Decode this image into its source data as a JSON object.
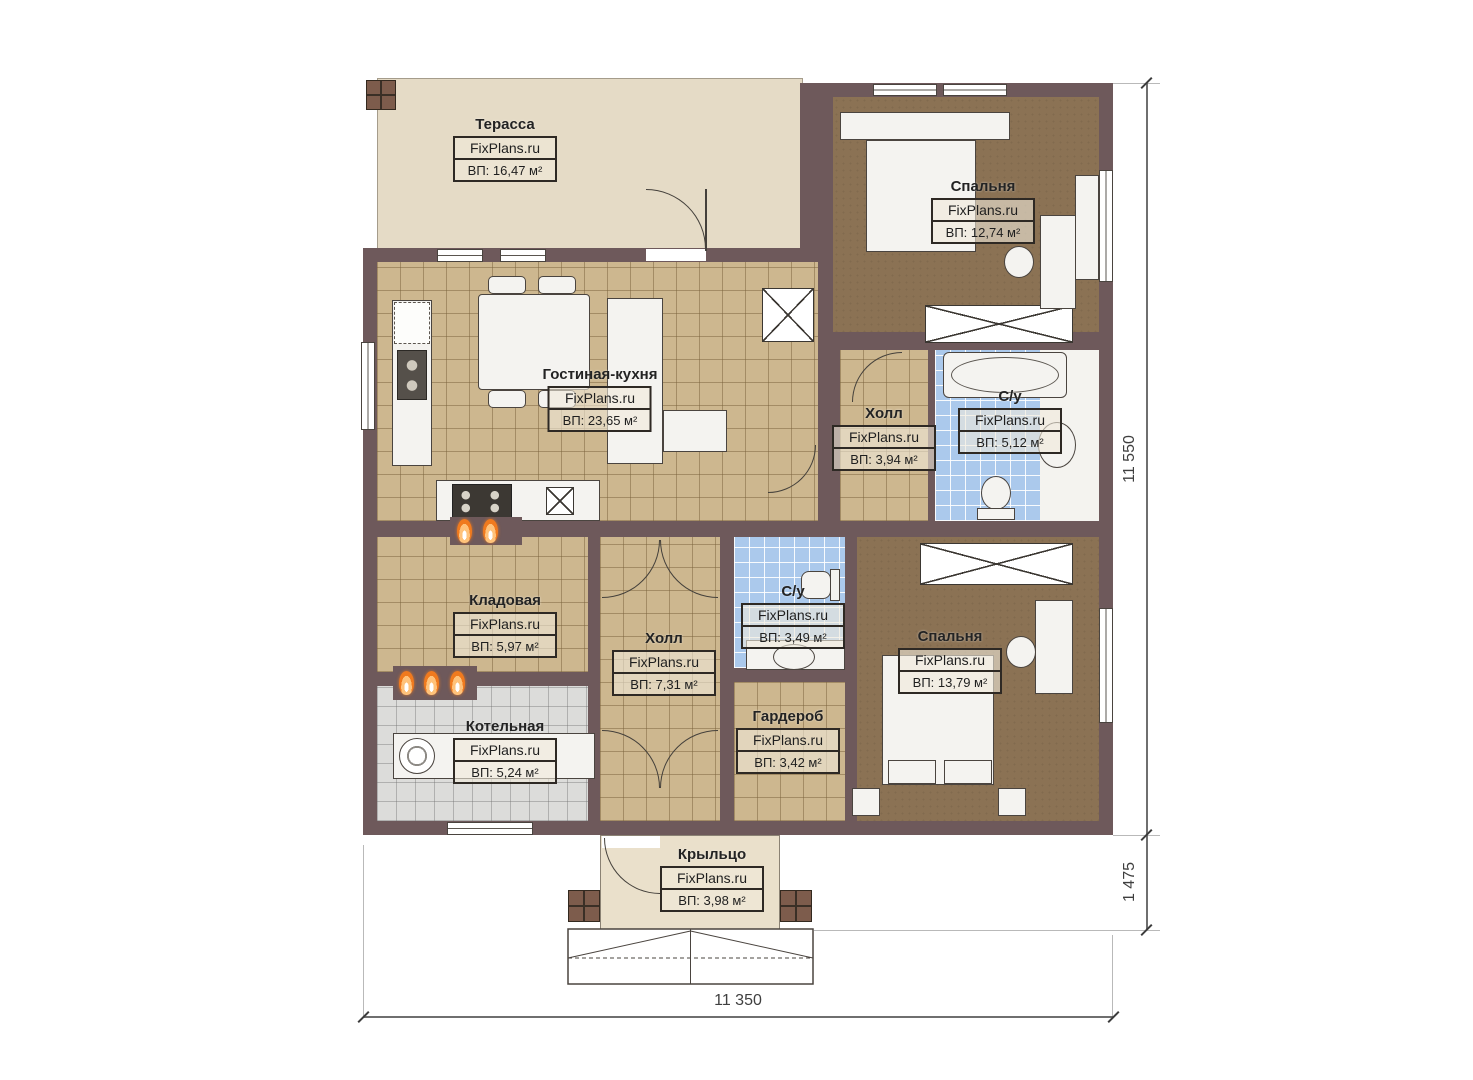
{
  "plan": {
    "watermark": "FixPlans.ru",
    "rooms": [
      {
        "name": "Терасса",
        "area": "ВП: 16,47 м²"
      },
      {
        "name": "Спальня",
        "area": "ВП: 12,74 м²"
      },
      {
        "name": "Гостиная-кухня",
        "area": "ВП: 23,65 м²"
      },
      {
        "name": "Холл",
        "area": "ВП: 3,94 м²"
      },
      {
        "name": "С/у",
        "area": "ВП: 5,12 м²"
      },
      {
        "name": "Кладовая",
        "area": "ВП: 5,97 м²"
      },
      {
        "name": "Холл",
        "area": "ВП: 7,31 м²"
      },
      {
        "name": "С/у",
        "area": "ВП: 3,49 м²"
      },
      {
        "name": "Спальня",
        "area": "ВП: 13,79 м²"
      },
      {
        "name": "Котельная",
        "area": "ВП: 5,24 м²"
      },
      {
        "name": "Гардероб",
        "area": "ВП: 3,42 м²"
      },
      {
        "name": "Крыльцо",
        "area": "ВП: 3,98 м²"
      }
    ],
    "dimensions": {
      "right_total": "11 550",
      "right_porch": "1 475",
      "bottom_width": "11 350"
    },
    "colors": {
      "wall": "#6e595b",
      "terrace": "#e5dbc6",
      "tile": "#cdb78f",
      "carpet": "#8b7254",
      "bath": "#abc9ec",
      "boiler": "#dcdcda",
      "porch": "#eae0cb",
      "flame": "#f07a1e",
      "line": "#44403b"
    },
    "icons": {
      "radiator": "flame-icon",
      "ventilation_shaft": "x-box",
      "wardrobe_unit": "x-box",
      "stairs": "hatched-steps"
    }
  }
}
